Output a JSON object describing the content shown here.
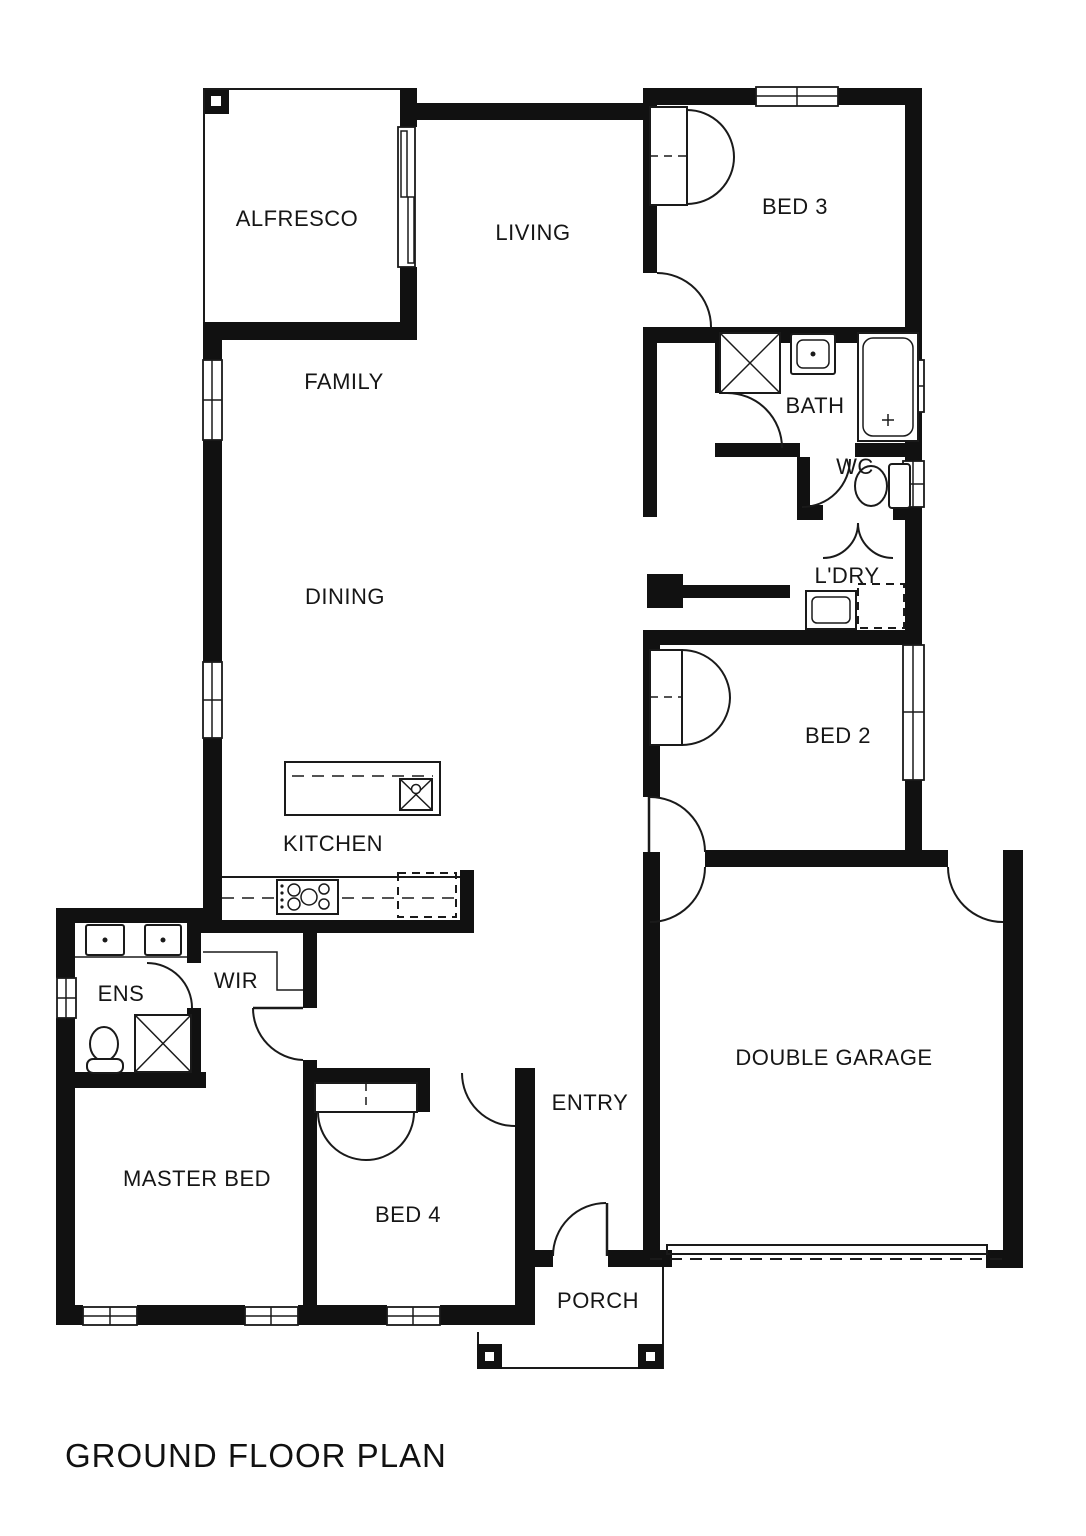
{
  "title": "GROUND FLOOR PLAN",
  "colors": {
    "wall": "#111111",
    "line": "#1a1a1a",
    "background": "#ffffff"
  },
  "rooms": [
    {
      "id": "alfresco",
      "label": "ALFRESCO"
    },
    {
      "id": "living",
      "label": "LIVING"
    },
    {
      "id": "bed3",
      "label": "BED 3"
    },
    {
      "id": "family",
      "label": "FAMILY"
    },
    {
      "id": "bath",
      "label": "BATH"
    },
    {
      "id": "wc",
      "label": "WC"
    },
    {
      "id": "ldry",
      "label": "L'DRY"
    },
    {
      "id": "dining",
      "label": "DINING"
    },
    {
      "id": "bed2",
      "label": "BED 2"
    },
    {
      "id": "kitchen",
      "label": "KITCHEN"
    },
    {
      "id": "ens",
      "label": "ENS"
    },
    {
      "id": "wir",
      "label": "WIR"
    },
    {
      "id": "master",
      "label": "MASTER BED"
    },
    {
      "id": "bed4",
      "label": "BED 4"
    },
    {
      "id": "entry",
      "label": "ENTRY"
    },
    {
      "id": "garage",
      "label": "DOUBLE GARAGE"
    },
    {
      "id": "porch",
      "label": "PORCH"
    }
  ],
  "fixtures": [
    "shower",
    "toilet",
    "bathtub",
    "vanity-sink",
    "double-vanity",
    "laundry-tub",
    "appliance-space",
    "cooktop",
    "island-sink",
    "fridge-space",
    "wardrobe",
    "porch-post"
  ]
}
